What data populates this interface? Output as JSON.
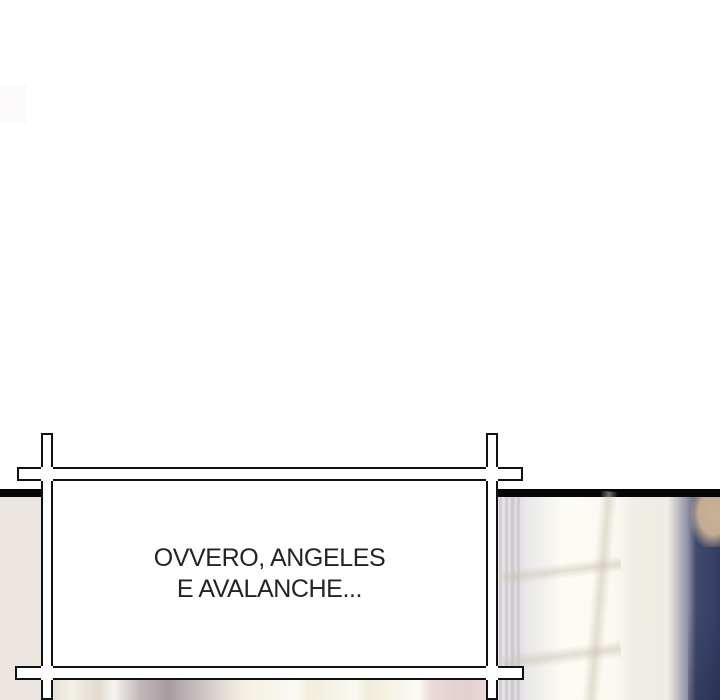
{
  "page": {
    "background_color": "#ffffff",
    "panel_divider_color": "#070707"
  },
  "caption": {
    "lines": [
      "OVVERO, ANGELES",
      "E AVALANCHE..."
    ],
    "text_color": "#242424",
    "box_fill": "#ffffff",
    "frame_color": "#111111"
  },
  "scene": {
    "colors": {
      "left_wall_beige": "#ece7e0",
      "window_glow_white": "#fcfbf4",
      "window_pane_cream": "#f2edda",
      "ivory_wall": "#efece4",
      "navy_curtain": "#3f4a6b",
      "mauve_band": "#a89ba1",
      "pink_band": "#e2cfd0",
      "tan_object": "#c9b194"
    }
  }
}
